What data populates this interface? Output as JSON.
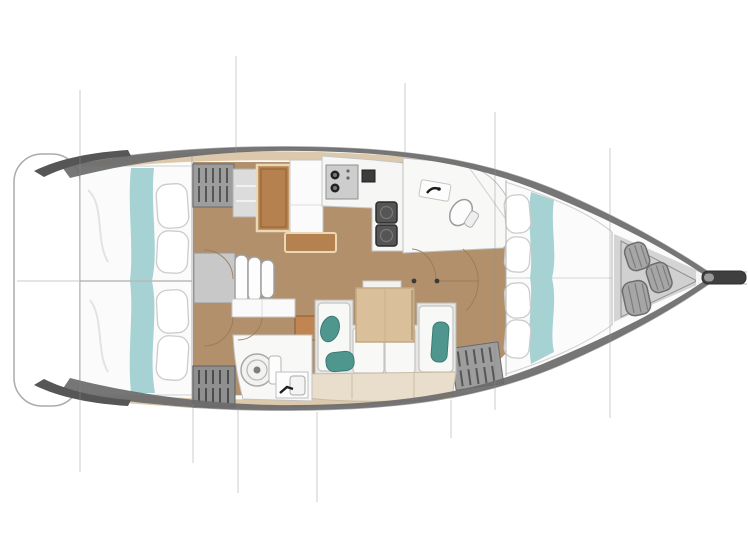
{
  "diagram": {
    "type": "sailboat-interior-floor-plan",
    "view": "top-down",
    "orientation": "bow-right-stern-left",
    "areas": [
      {
        "id": "transom",
        "name": "stern transom / swim platform"
      },
      {
        "id": "aft-cabin-top",
        "name": "aft double cabin (upper)"
      },
      {
        "id": "aft-cabin-bottom",
        "name": "aft double cabin (lower)"
      },
      {
        "id": "companionway",
        "name": "companionway steps"
      },
      {
        "id": "nav-station",
        "name": "chart table / nav station"
      },
      {
        "id": "galley",
        "name": "galley with stove and double sink"
      },
      {
        "id": "aft-head",
        "name": "head with toilet, sink and shower (upper)"
      },
      {
        "id": "saloon",
        "name": "saloon with U-sofa and folding table"
      },
      {
        "id": "day-head",
        "name": "head with toilet and sink (lower)"
      },
      {
        "id": "forward-cabin",
        "name": "forward V-berth cabin"
      },
      {
        "id": "anchor-locker",
        "name": "bow anchor/sail locker with rope coils"
      },
      {
        "id": "bowsprit",
        "name": "bowsprit / anchor roller"
      }
    ],
    "features": {
      "cabins": 3,
      "heads": 2,
      "berth_runners": 3,
      "rope_coils": 3,
      "companionway_steps": 3,
      "stove_burners": 2,
      "sink_basins": 2,
      "teal_cushions": 3,
      "storage_lockers": 4
    },
    "section_lines_x": [
      80,
      193,
      236,
      317,
      405,
      451,
      495,
      610
    ]
  },
  "colors": {
    "hull_line": "#a6a6a6",
    "rim_dark": "#6a6a6a",
    "rim_cap": "#565656",
    "deck_tan": "#dcc9ab",
    "floor_brown": "#b3906c",
    "wood_dark": "#b5824f",
    "wood_border": "#ead7b5",
    "table_wood": "#d9c09a",
    "teal_light": "#a6d2d3",
    "teal_dark": "#4f978e",
    "sofa_gray": "#e6e6e3",
    "cushion_white": "#f8f8f7",
    "storage_beige": "#e9decb",
    "locker_gray": "#9d9d9d",
    "locker_slat": "#565656",
    "steel_dark": "#3f3f3f",
    "deck_gray": "#d4d4d4",
    "bow_locker": "#d0d0d0",
    "coil_gray": "#a6a6a6",
    "arc_brown": "#97795a",
    "section_line": "#8f8f8f",
    "bed_white": "#fbfbfb"
  }
}
